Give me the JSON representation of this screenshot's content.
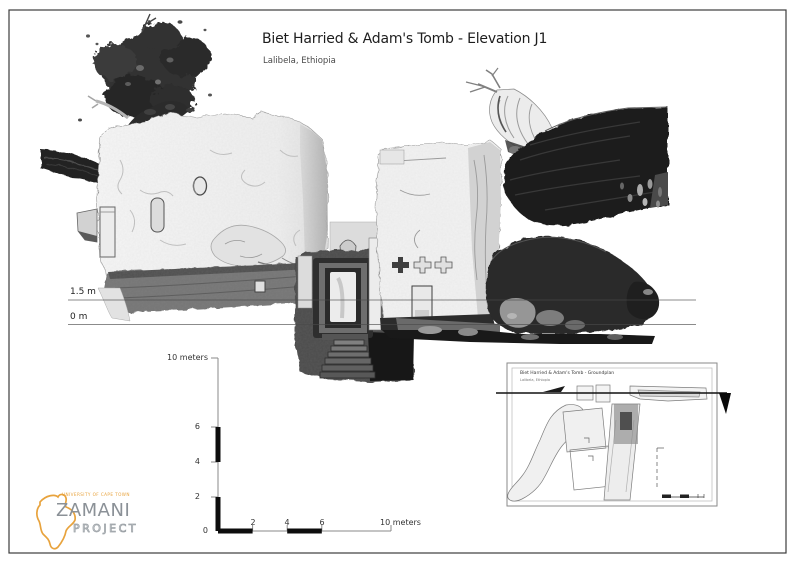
{
  "sheet": {
    "title": "Biet Harried & Adam's Tomb - Elevation J1",
    "subtitle": "Lalibela, Ethiopia"
  },
  "elevation_markers": {
    "upper": "1.5 m",
    "lower": "0 m"
  },
  "scale_bar": {
    "max_label": "10 meters",
    "vertical_ticks": [
      "6",
      "4",
      "2"
    ],
    "horizontal_ticks": [
      "2",
      "4",
      "6"
    ],
    "origin": "0"
  },
  "inset": {
    "title": "Biet Harried & Adam's Tomb - Groundplan",
    "subtitle": "Lalibela, Ethiopia"
  },
  "logo": {
    "institution": "UNIVERSITY OF CAPE TOWN",
    "name": "ZAMANI",
    "subname": "PROJECT"
  },
  "colors": {
    "logo_accent": "#E8A33D",
    "logo_text": "#8B9197",
    "ink": "#1D1D1D",
    "datum_line": "#555555"
  }
}
